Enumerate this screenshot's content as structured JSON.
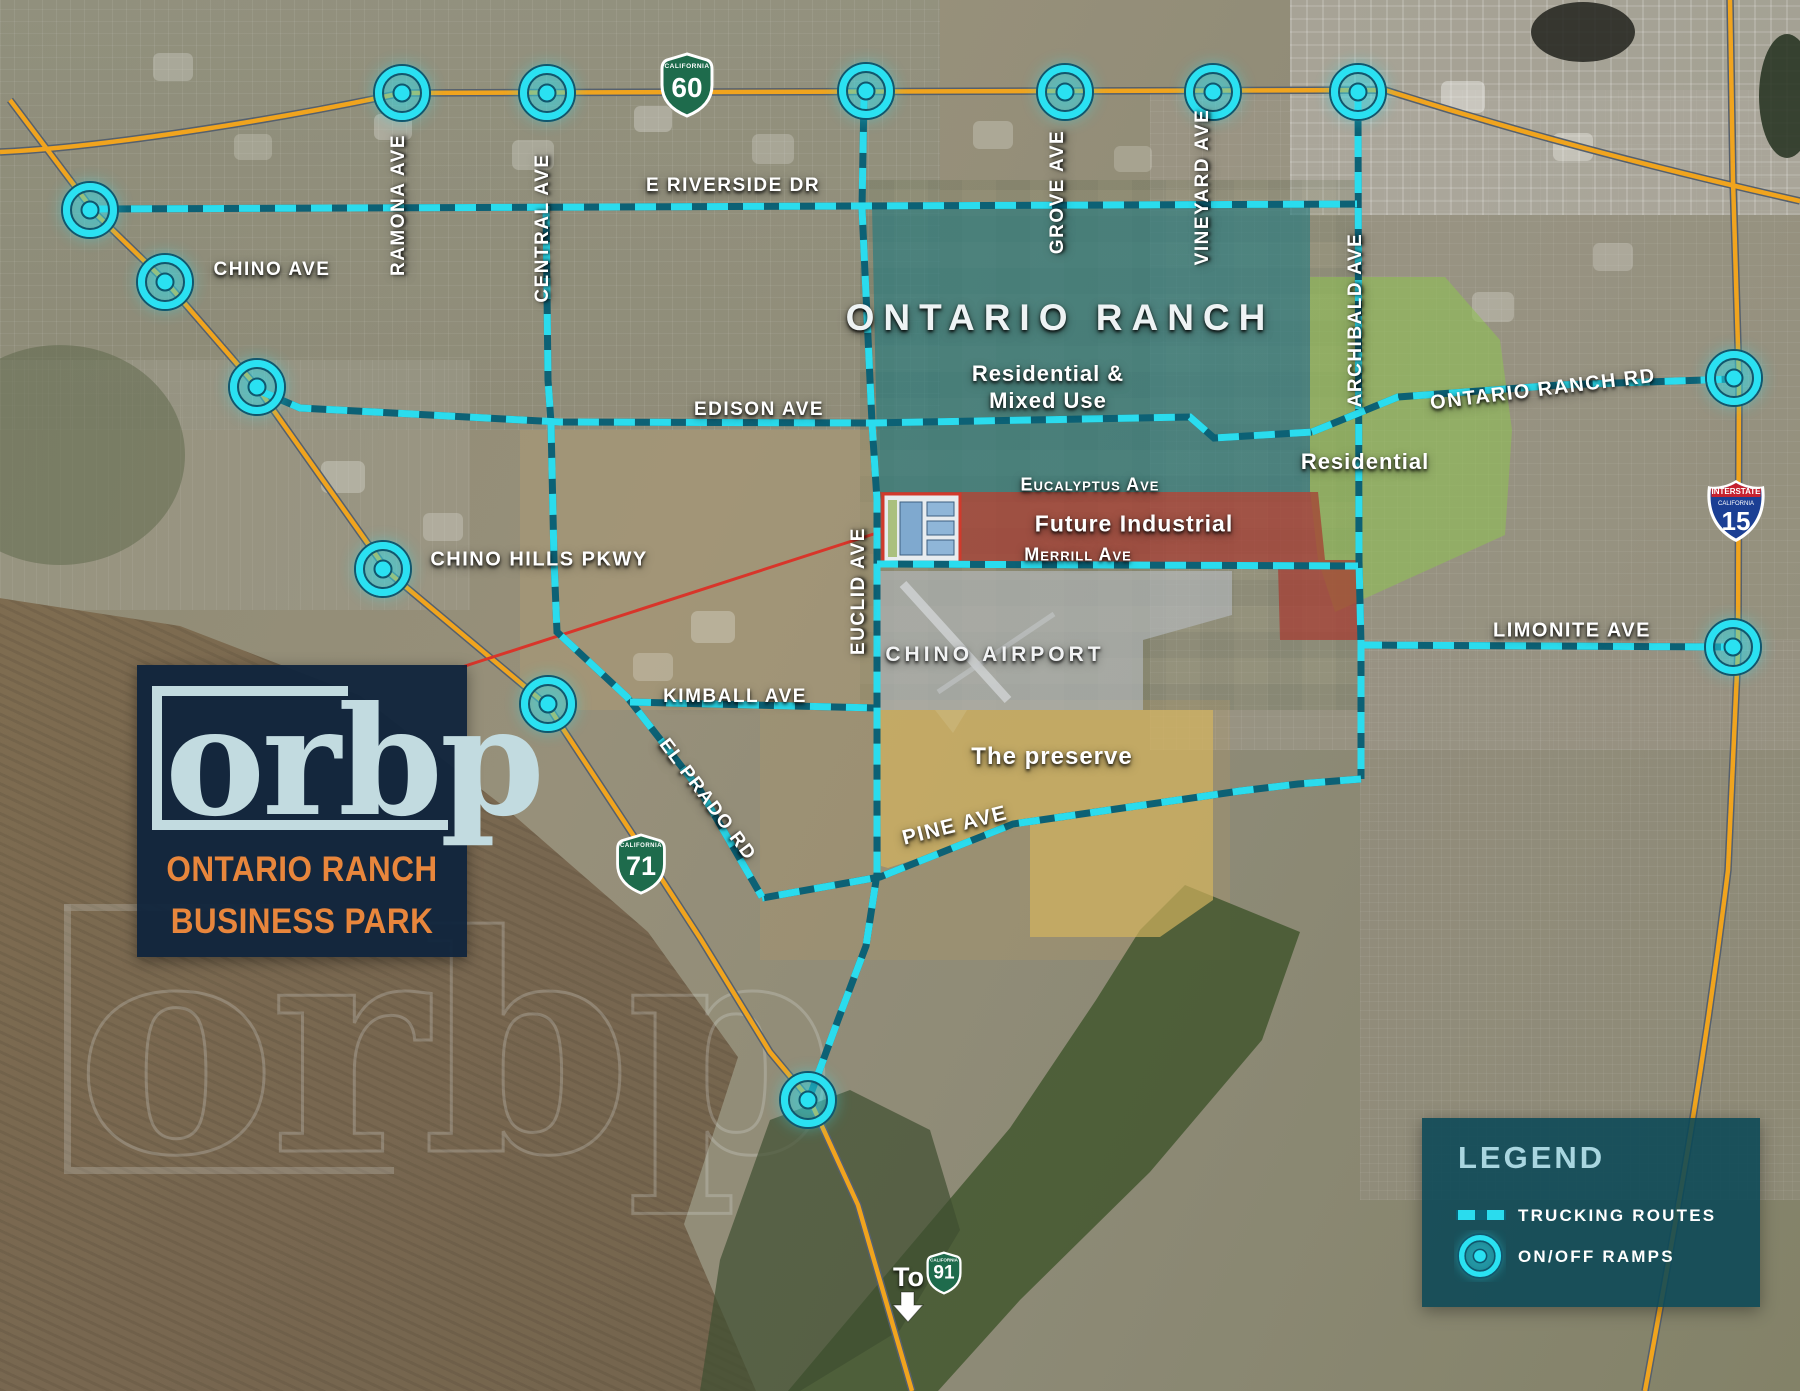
{
  "logo": {
    "mark": "orbp",
    "line1": "ONTARIO RANCH",
    "line2": "BUSINESS PARK"
  },
  "watermark": {
    "mark": "orbp"
  },
  "legend": {
    "title": "LEGEND",
    "trucking_label": "TRUCKING ROUTES",
    "ramps_label": "ON/OFF RAMPS"
  },
  "areas": {
    "ontario_ranch": {
      "title": "ONTARIO RANCH",
      "sub1": "Residential &",
      "sub2": "Mixed Use"
    },
    "residential": {
      "label": "Residential"
    },
    "future_industrial": {
      "label": "Future Industrial"
    },
    "chino_airport": {
      "label": "CHINO AIRPORT"
    },
    "preserve": {
      "label": "The preserve"
    }
  },
  "streets": {
    "ramona": "RAMONA AVE",
    "central": "CENTRAL AVE",
    "e_riverside": "E RIVERSIDE DR",
    "chino_ave": "CHINO AVE",
    "grove": "GROVE AVE",
    "vineyard": "VINEYARD AVE",
    "archibald": "ARCHIBALD AVE",
    "ontario_ranch_rd": "ONTARIO RANCH RD",
    "edison": "EDISON AVE",
    "eucalyptus": "Eucalyptus Ave",
    "merrill": "Merrill Ave",
    "chino_hills": "CHINO HILLS PKWY",
    "euclid": "EUCLID AVE",
    "kimball": "KIMBALL AVE",
    "el_prado": "EL PRADO RD",
    "limonite": "LIMONITE AVE",
    "pine": "PINE AVE"
  },
  "shields": {
    "ca60": {
      "state": "CALIFORNIA",
      "num": "60"
    },
    "ca71": {
      "state": "CALIFORNIA",
      "num": "71"
    },
    "ca91": {
      "state": "CALIFORNIA",
      "num": "91"
    },
    "i15": {
      "band": "INTERSTATE",
      "state": "CALIFORNIA",
      "num": "15"
    },
    "to91": {
      "prefix": "To"
    }
  },
  "colors": {
    "route_cyan": "#2ADCEE",
    "route_dark": "#0C6175",
    "ramp_cyan": "#2AE1F2",
    "highway_orange": "#F0A41E",
    "teal_area": "#1F7A80",
    "green_area": "#8FBE55",
    "red_area": "#A63A31",
    "gray_area": "#B7BBC0",
    "yellow_area": "#D5B55E",
    "legend_bg": "#0A4856",
    "logo_bg": "#0F243C",
    "logo_orange": "#E8863C",
    "logo_light": "#C2DBE0"
  }
}
